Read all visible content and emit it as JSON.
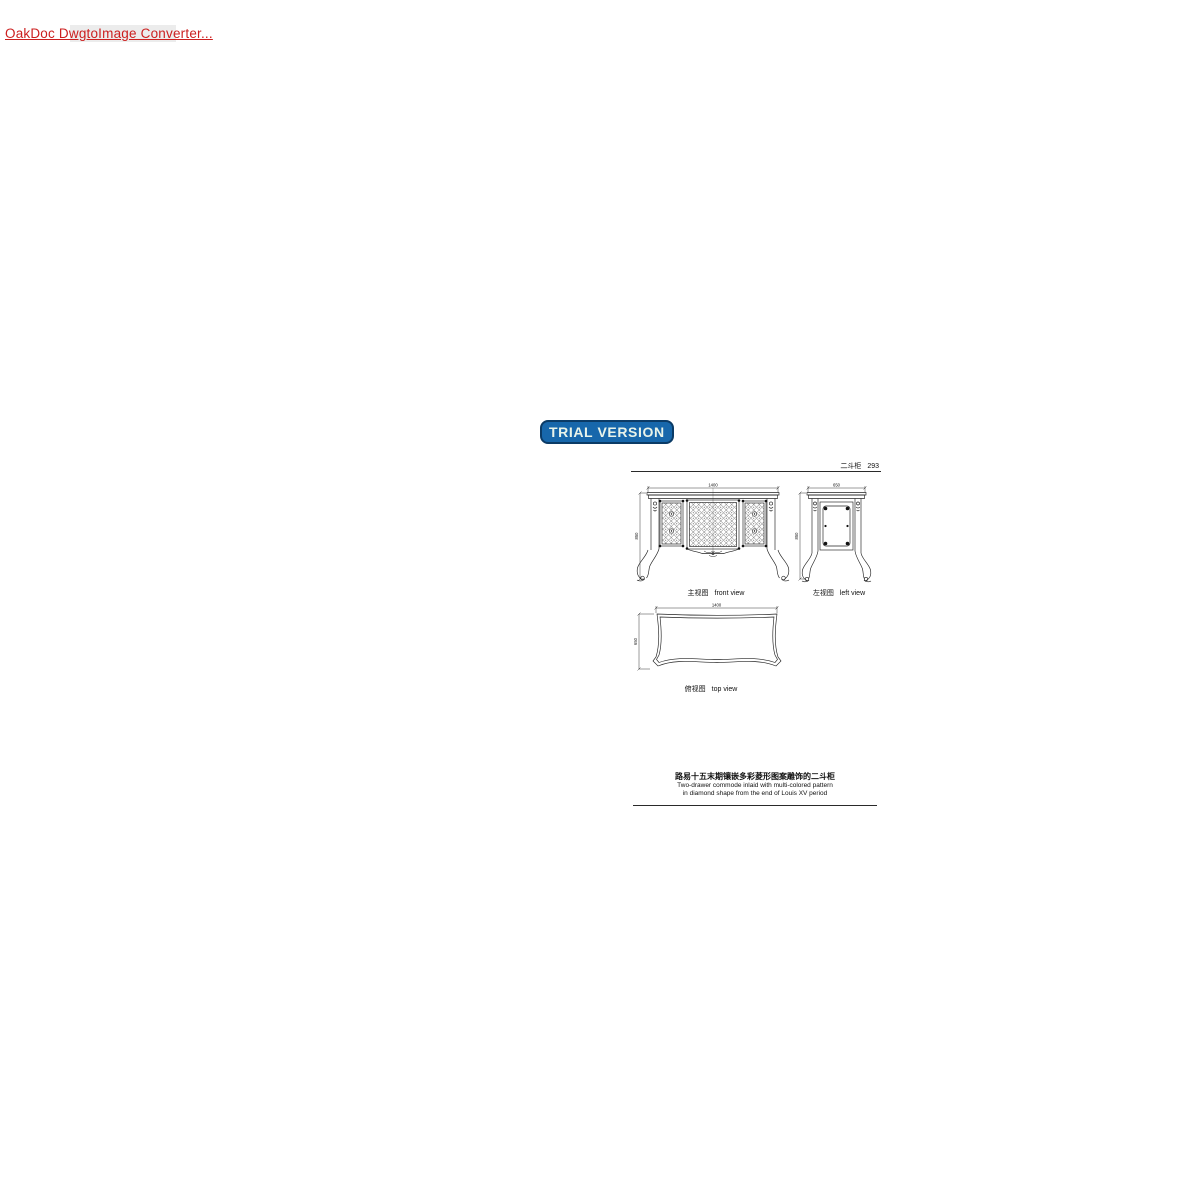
{
  "watermark": {
    "link_text": "OakDoc DwgtoImage Converter...",
    "badge_text": "TRIAL VERSION",
    "link_color": "#cc1f1f",
    "badge_bg": "#1767ab",
    "badge_border": "#0b3b66",
    "badge_text_color": "#e9f4ea"
  },
  "sheet": {
    "line_color": "#1c1c1c",
    "header": {
      "title": "二斗柜",
      "page_number": "293"
    },
    "views": {
      "front": {
        "label_zh": "主视图",
        "label_en": "front view",
        "dim_width": "1400",
        "dim_height": "850"
      },
      "left": {
        "label_zh": "左视图",
        "label_en": "left view",
        "dim_width": "650",
        "dim_height": "850"
      },
      "top": {
        "label_zh": "俯视图",
        "label_en": "top view",
        "dim_width": "1400",
        "dim_depth": "650"
      }
    },
    "caption": {
      "title_zh": "路易十五末期镶嵌多彩菱形图案雕饰的二斗柜",
      "subtitle_en_line1": "Two-drawer commode inlaid with multi-colored pattern",
      "subtitle_en_line2": "in diamond shape from the end of Louis XV period"
    }
  }
}
